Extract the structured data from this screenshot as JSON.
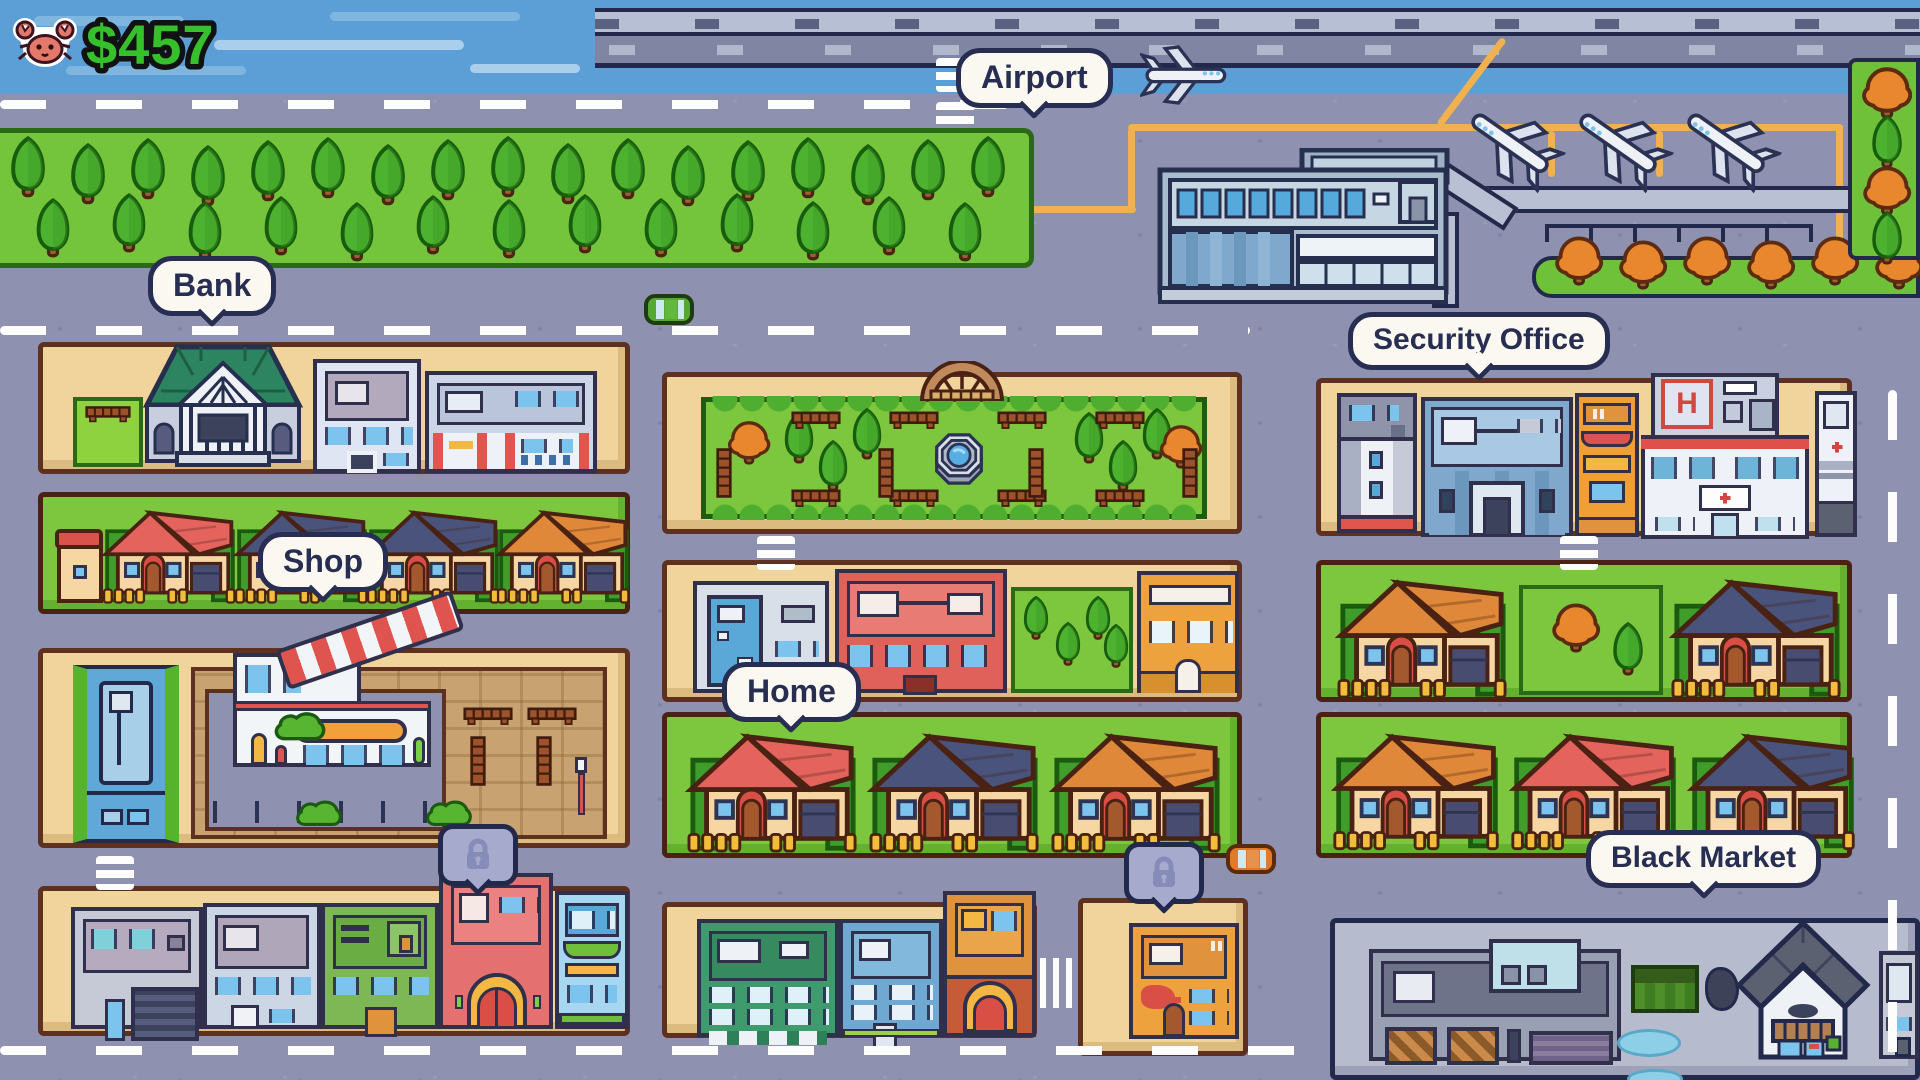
{
  "hud": {
    "icon": "crab-icon",
    "balance": "$457"
  },
  "labels": {
    "airport": "Airport",
    "bank": "Bank",
    "shop": "Shop",
    "home": "Home",
    "security_office": "Security Office",
    "black_market": "Black Market",
    "hospital_heliport": "H"
  },
  "markers": {
    "locked_icon": "lock-icon",
    "locked_count": 2
  },
  "colors": {
    "money_green": "#35c02c",
    "bubble_fill": "#faf8f1",
    "bubble_ink": "#272e52",
    "road": "#8e92b0",
    "water": "#5b9fd6",
    "grass": "#74c43c",
    "lot_tan": "#f1d49c",
    "lock_bubble": "#a6abce"
  }
}
